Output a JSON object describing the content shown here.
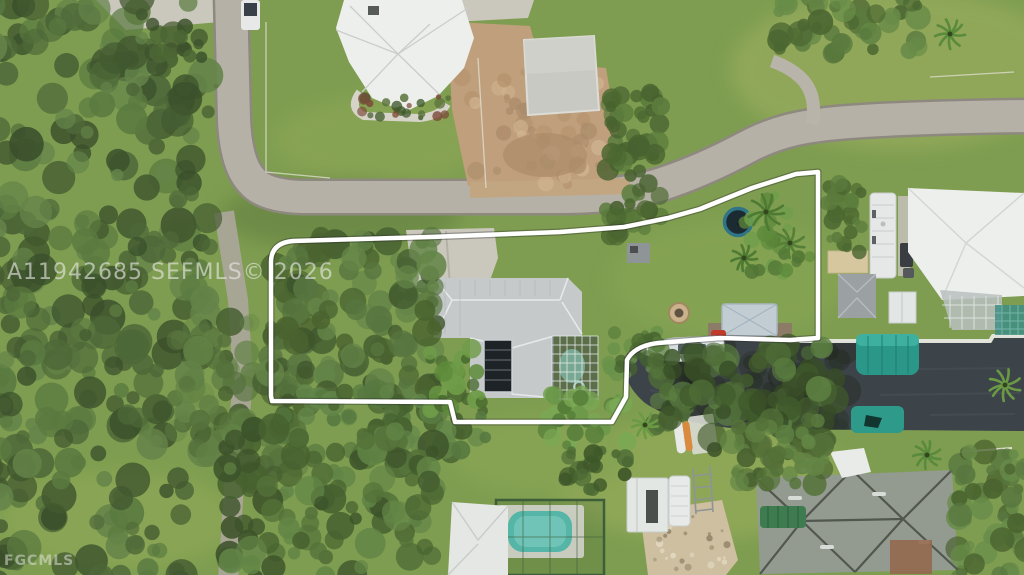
{
  "meta": {
    "width": 1024,
    "height": 575,
    "kind": "aerial drone photo of a residential lot outlined in white, with canal, boats and neighboring homes"
  },
  "watermarks": {
    "listing_id": "A11942685 SEFMLS© 2026",
    "provider": "FGCMLS"
  },
  "palette": {
    "grass": "#7e9d50",
    "grass_light": "#9db25f",
    "woods": "#4a612f",
    "road": "#b6b1a6",
    "road_edge": "#928d83",
    "dirt": "#bf9f7c",
    "concrete": "#cac7bd",
    "water": "#3d4449",
    "roof_white": "#edefec",
    "roof_light_gray": "#c5c9ca",
    "roof_dark_gray": "#939a8f",
    "pool_blue": "#55b5a7",
    "teal_canopy": "#2a9789",
    "boundary_white": "#ffffff",
    "trampoline_ring": "#2f7487",
    "trampoline_mat": "#1c2a32",
    "dock_brown": "#8b7b67",
    "awning_green": "#3e7c50",
    "sand": "#cdbfa0",
    "kayak_orange": "#d98a3f"
  }
}
